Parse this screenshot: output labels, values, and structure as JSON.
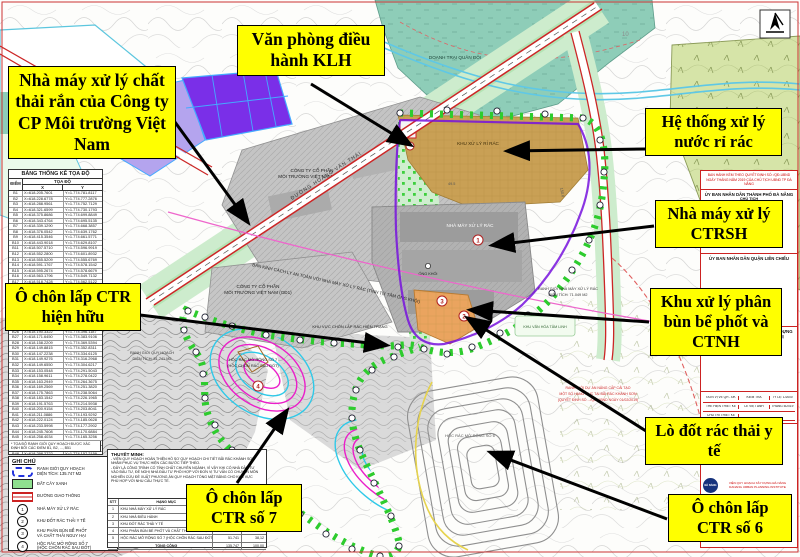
{
  "colors": {
    "callout_bg": "#ffff00",
    "boundary_blue": "#2233dd",
    "plant_boundary_purple": "#7712dd",
    "contour_magenta": "#e81ec8",
    "contour_cyan": "#2fc9e8",
    "leachate_tan": "#c9a055",
    "sludge_orange": "#eaa45f",
    "military_teal": "#8ecdb8",
    "vegetation_olive": "#d6e4a8",
    "road_red": "#cc2626"
  },
  "callouts": {
    "nha_may_vn": "Nhà máy xử lý chất thải rắn của Công ty CP Môi trường Việt Nam",
    "van_phong": "Văn phòng điều hành KLH",
    "he_thong": "Hệ thống xử lý nước rỉ rác",
    "ctrsh": "Nhà máy xử lý CTRSH",
    "phan_bun": "Khu xử lý phân bùn bể phốt và CTNH",
    "lo_dot": "Lò đốt rác thải y tế",
    "so6": "Ô chôn lấp CTR số 6",
    "so7": "Ô chôn lấp CTR số 7",
    "hien_huu": "Ô chôn lấp CTR hiện hữu"
  },
  "map_labels": {
    "doanh_trai": "DOANH TRẠI QUÂN ĐỘI",
    "cty_gd2_l1": "CÔNG TY CỔ PHẦN",
    "cty_gd2_l2": "MÔI TRƯỜNG VIỆT NAM (GĐ2)",
    "cty_gd1_l1": "CÔNG TY CỔ PHẦN",
    "cty_gd1_l2": "MÔI TRƯỜNG VIỆT NAM (GĐ1)",
    "khu_ri_rac": "KHU XỬ LÝ RỈ RÁC",
    "nha_may": "NHÀ MÁY XỬ LÝ RÁC",
    "ong_khoi": "ỐNG KHÓI",
    "rg_nm_l1": "RANH GIỚI NHÀ MÁY XỬ LÝ RÁC",
    "rg_nm_l2": "DIỆN TÍCH: 71.049 M2",
    "rg_qh_l1": "RANH GIỚI QUY HOẠCH",
    "rg_qh_l2": "DIỆN TÍCH: 51.741 M2",
    "hoc7_l1": "HỘC RÁC MỞ RỘNG SỐ 7",
    "hoc7_l2": "(HỘC CHÔN RÁC SAU ĐỐT)",
    "hien_trang": "KHU VỰC CHÔN LẤP RÁC HIỆN TRẠNG",
    "hoc6": "HỘC RÁC MỞ RỘNG SỐ 6",
    "van_hoa": "KHU VĂN HÓA TÂM LINH",
    "rg_da_l1": "RANH GIỚI DỰ ÁN NÂNG CẤP CẢI TẠO",
    "rg_da_l2": "MỘT SỐ HẠNG MỤC TẠI BÃI RÁC KHÁNH SƠN",
    "rg_da_l3": "(QUYẾT ĐỊNH SỐ .../QĐ-UBND NGÀY 01/02/2019)",
    "ban_kinh": "BÁN KÍNH CÁCH LY AN TOÀN VỚI NHÀ MÁY XỬ LÝ RÁC (TÍNH TỪ TÂM ỐNG KHÓI)",
    "duong_hvt": "ĐƯỜNG HOÀNG VĂN THÁI",
    "contour10": "10",
    "dim1": "150.0",
    "dim2": "49.5"
  },
  "facilities": {
    "m1": "1",
    "m2": "2",
    "m3": "3",
    "m4": "4"
  },
  "coord_table": {
    "title": "BẢNG THỐNG KÊ TỌA ĐỘ",
    "col_point": "ĐIỂM",
    "col_coord": "TỌA ĐỘ",
    "col_x": "X",
    "col_y": "Y",
    "note": "* TỌA ĐỘ RANH GIỚI QUY HOẠCH ĐƯỢC XÁC ĐỊNH BỞI CÁC ĐIỂM B1, B2, ..., B51",
    "rows": [
      [
        "B1",
        "X=618.205.7601",
        "Y=1.774.781.8117"
      ],
      [
        "B2",
        "X=618.228.6778",
        "Y=1.774.777.2876"
      ],
      [
        "B3",
        "X=618.288.9561",
        "Y=1.774.752.7129"
      ],
      [
        "B4",
        "X=618.321.6599",
        "Y=1.774.730.1793"
      ],
      [
        "B5",
        "X=618.375.8686",
        "Y=1.774.699.8849"
      ],
      [
        "B6",
        "X=618.343.4764",
        "Y=1.774.695.5135"
      ],
      [
        "B7",
        "X=618.339.1290",
        "Y=1.774.668.3857"
      ],
      [
        "B8",
        "X=618.376.0542",
        "Y=1.774.639.1762"
      ],
      [
        "B9",
        "X=618.415.3546",
        "Y=1.774.661.5771"
      ],
      [
        "B10",
        "X=618.443.9018",
        "Y=1.774.629.8107"
      ],
      [
        "B11",
        "X=618.507.5710",
        "Y=1.774.596.9919"
      ],
      [
        "B12",
        "X=618.552.2800",
        "Y=1.774.601.8932"
      ],
      [
        "B13",
        "X=618.555.5209",
        "Y=1.774.555.6769"
      ],
      [
        "B14",
        "X=618.591.1767",
        "Y=1.774.578.1542"
      ],
      [
        "B15",
        "X=618.595.2674",
        "Y=1.774.578.6679"
      ],
      [
        "B16",
        "X=618.563.1796",
        "Y=1.774.549.7132"
      ],
      [
        "B17",
        "X=618.518.7428",
        "Y=1.774.562.5122"
      ],
      [
        "B18",
        "X=618.418.2201",
        "Y=1.774.561.1407"
      ],
      [
        "B19",
        "X=618.393.8226",
        "Y=1.774.507.8528"
      ],
      [
        "B20",
        "X=618.345.3480",
        "Y=1.774.481.7790"
      ],
      [
        "B21",
        "X=618.320.1744",
        "Y=1.774.459.2466"
      ],
      [
        "B22",
        "X=618.295.8290",
        "Y=1.774.441.0052"
      ],
      [
        "B23",
        "X=618.268.4417",
        "Y=1.774.427.6189"
      ],
      [
        "B24",
        "X=618.241.0886",
        "Y=1.774.419.3301"
      ],
      [
        "B25",
        "X=618.214.7599",
        "Y=1.774.408.5240"
      ],
      [
        "B26",
        "X=618.190.3322",
        "Y=1.774.396.1187"
      ],
      [
        "B27",
        "X=618.171.6450",
        "Y=1.774.383.9106"
      ],
      [
        "B28",
        "X=618.158.2209",
        "Y=1.774.369.5394"
      ],
      [
        "B29",
        "X=618.149.8815",
        "Y=1.774.352.8311"
      ],
      [
        "B30",
        "X=618.147.2238",
        "Y=1.774.334.6125"
      ],
      [
        "B31",
        "X=618.149.9276",
        "Y=1.774.316.2968"
      ],
      [
        "B32",
        "X=618.149.6550",
        "Y=1.774.304.6217"
      ],
      [
        "B33",
        "X=618.153.0548",
        "Y=1.774.291.5043"
      ],
      [
        "B34",
        "X=618.158.9611",
        "Y=1.774.278.0422"
      ],
      [
        "B35",
        "X=618.163.2949",
        "Y=1.774.264.3675"
      ],
      [
        "B36",
        "X=618.169.2569",
        "Y=1.774.251.3820"
      ],
      [
        "B37",
        "X=618.175.7863",
        "Y=1.774.238.5064"
      ],
      [
        "B38",
        "X=618.183.1542",
        "Y=1.774.226.1965"
      ],
      [
        "B39",
        "X=618.191.5763",
        "Y=1.774.214.5938"
      ],
      [
        "B40",
        "X=618.200.9154",
        "Y=1.774.203.8041"
      ],
      [
        "B41",
        "X=618.211.0886",
        "Y=1.774.193.9292"
      ],
      [
        "B42",
        "X=618.222.0124",
        "Y=1.774.185.0628"
      ],
      [
        "B43",
        "X=618.233.5998",
        "Y=1.774.177.2902"
      ],
      [
        "B44",
        "X=618.245.7608",
        "Y=1.774.170.6884"
      ],
      [
        "B45",
        "X=618.258.4034",
        "Y=1.774.165.3256"
      ],
      [
        "B46",
        "X=618.271.4333",
        "Y=1.774.161.2609"
      ],
      [
        "B47",
        "X=618.284.7550",
        "Y=1.774.158.5443"
      ],
      [
        "B48",
        "X=618.298.2722",
        "Y=1.774.157.2159"
      ],
      [
        "B49",
        "X=618.311.8883",
        "Y=1.774.157.3066"
      ],
      [
        "B50",
        "X=618.325.5063",
        "Y=1.774.158.8369"
      ],
      [
        "B51",
        "X=618.339.0295",
        "Y=1.774.161.8174"
      ]
    ]
  },
  "legend": {
    "title": "GHI CHÚ",
    "items": [
      {
        "swatch": "boundary",
        "num": "",
        "label": "RANH GIỚI QUY HOẠCH\nDIỆN TÍCH: 135.747 M2"
      },
      {
        "swatch": "green",
        "num": "",
        "label": "ĐẤT CÂY XANH"
      },
      {
        "swatch": "road",
        "num": "",
        "label": "ĐƯỜNG GIAO THÔNG"
      },
      {
        "swatch": "circ",
        "num": "1",
        "label": "NHÀ MÁY XỬ LÝ RÁC"
      },
      {
        "swatch": "circ",
        "num": "2",
        "label": "KHU ĐỐT RÁC THẢI Y TẾ"
      },
      {
        "swatch": "circ",
        "num": "3",
        "label": "KHU PHÂN BÙN BỂ PHỐT\nVÀ CHẤT THẢI NGUY HẠI"
      },
      {
        "swatch": "circ",
        "num": "4",
        "label": "HỘC RÁC MỞ RỘNG SỐ 7\n(HỘC CHÔN RÁC SAU ĐỐT)"
      }
    ]
  },
  "notes": {
    "title": "THUYẾT MINH:",
    "lines": [
      "- VIỆN QUY HOẠCH HOÀN THIỆN HỒ SƠ QUY HOẠCH CHI TIẾT BÃI RÁC KHÁNH SƠN",
      "NHẰM PHỤC VỤ THỰC HIỆN CÁC BƯỚC TIẾP THEO.",
      "- ĐÂY LÀ CÔNG TRÌNH CÓ TÍNH CHẤT CHUYÊN NGÀNH, VÌ VẬY KHI CÓ NHÀ ĐẦU TƯ",
      "VÀO ĐẦU TƯ, ĐỀ NGHỊ NHÀ ĐẦU TƯ PHỐI HỢP VỚI ĐƠN VỊ TƯ VẤN CÓ CHUYÊN MÔN",
      "NGHIÊN CỨU ĐỀ XUẤT PHƯƠNG ÁN QUY HOẠCH TỔNG MẶT BẰNG CHO KHU VỰC",
      "PHÙ HỢP VỚI NHU CẦU THỰC TẾ."
    ]
  },
  "area_table": {
    "header": [
      "STT",
      "HẠNG MỤC",
      "DIỆN TÍCH (M2)",
      "TỶ LỆ (%)"
    ],
    "rows": [
      [
        "1",
        "KHU NHÀ MÁY XỬ LÝ RÁC",
        "",
        ""
      ],
      [
        "2",
        "KHU NHÀ ĐIỀU HÀNH",
        "",
        ""
      ],
      [
        "3",
        "KHU ĐỐT RÁC THẢI Y TẾ",
        "",
        ""
      ],
      [
        "4",
        "KHU PHÂN BÙN BỂ PHỐT VÀ CHẤT THẢI NGUY HẠI",
        "",
        ""
      ],
      [
        "5",
        "HỘC RÁC MỞ RỘNG SỐ 7 (HỘC CHÔN RÁC SAU ĐỐT)",
        "51.741",
        "38,12"
      ]
    ],
    "total": [
      "TỔNG CỘNG",
      "135.747",
      "100,00"
    ]
  },
  "title_block": {
    "issue_l1": "BAN HÀNH KÈM THEO QUYẾT ĐỊNH SỐ:        /QĐ-UBND",
    "issue_l2": "NGÀY      THÁNG      NĂM 2019 CỦA CHỦ TỊCH UBND TP ĐÀ NẴNG",
    "ubnd_tp": "ỦY BAN NHÂN DÂN THÀNH PHỐ ĐÀ NẴNG",
    "chu_tich": "CHỦ TỊCH",
    "ubnd_quan": "ỦY BAN NHÂN DÂN QUẬN LIÊN CHIỂU",
    "bql_l1": "BAN QUẢN LÝ DỰ ÁN ĐẦU TƯ XÂY DỰNG",
    "bql_l2": "HẠ TẦNG VÀ PHÁT TRIỂN ĐÔ THỊ",
    "giam_doc": "GIÁM ĐỐC",
    "sig_rows": [
      [
        "ĐƠN VỊ VẼ QH - ĐK",
        "KIỂM TRA",
        "TỶ LỆ: 1/2000"
      ],
      [
        "THỂ HIỆN THIẾT KẾ",
        "LÊ VIỆT ANH",
        "THÁNG 5/2019"
      ],
      [
        "CHỦ TRÌ THIẾT KẾ",
        "",
        ""
      ]
    ],
    "inst_l1": "VIỆN QUY HOẠCH XÂY DỰNG ĐÀ NẴNG",
    "inst_l2": "DANANG URBAN PLANNING INSTITUTE",
    "logo": "ĐÀ NẴNG"
  }
}
